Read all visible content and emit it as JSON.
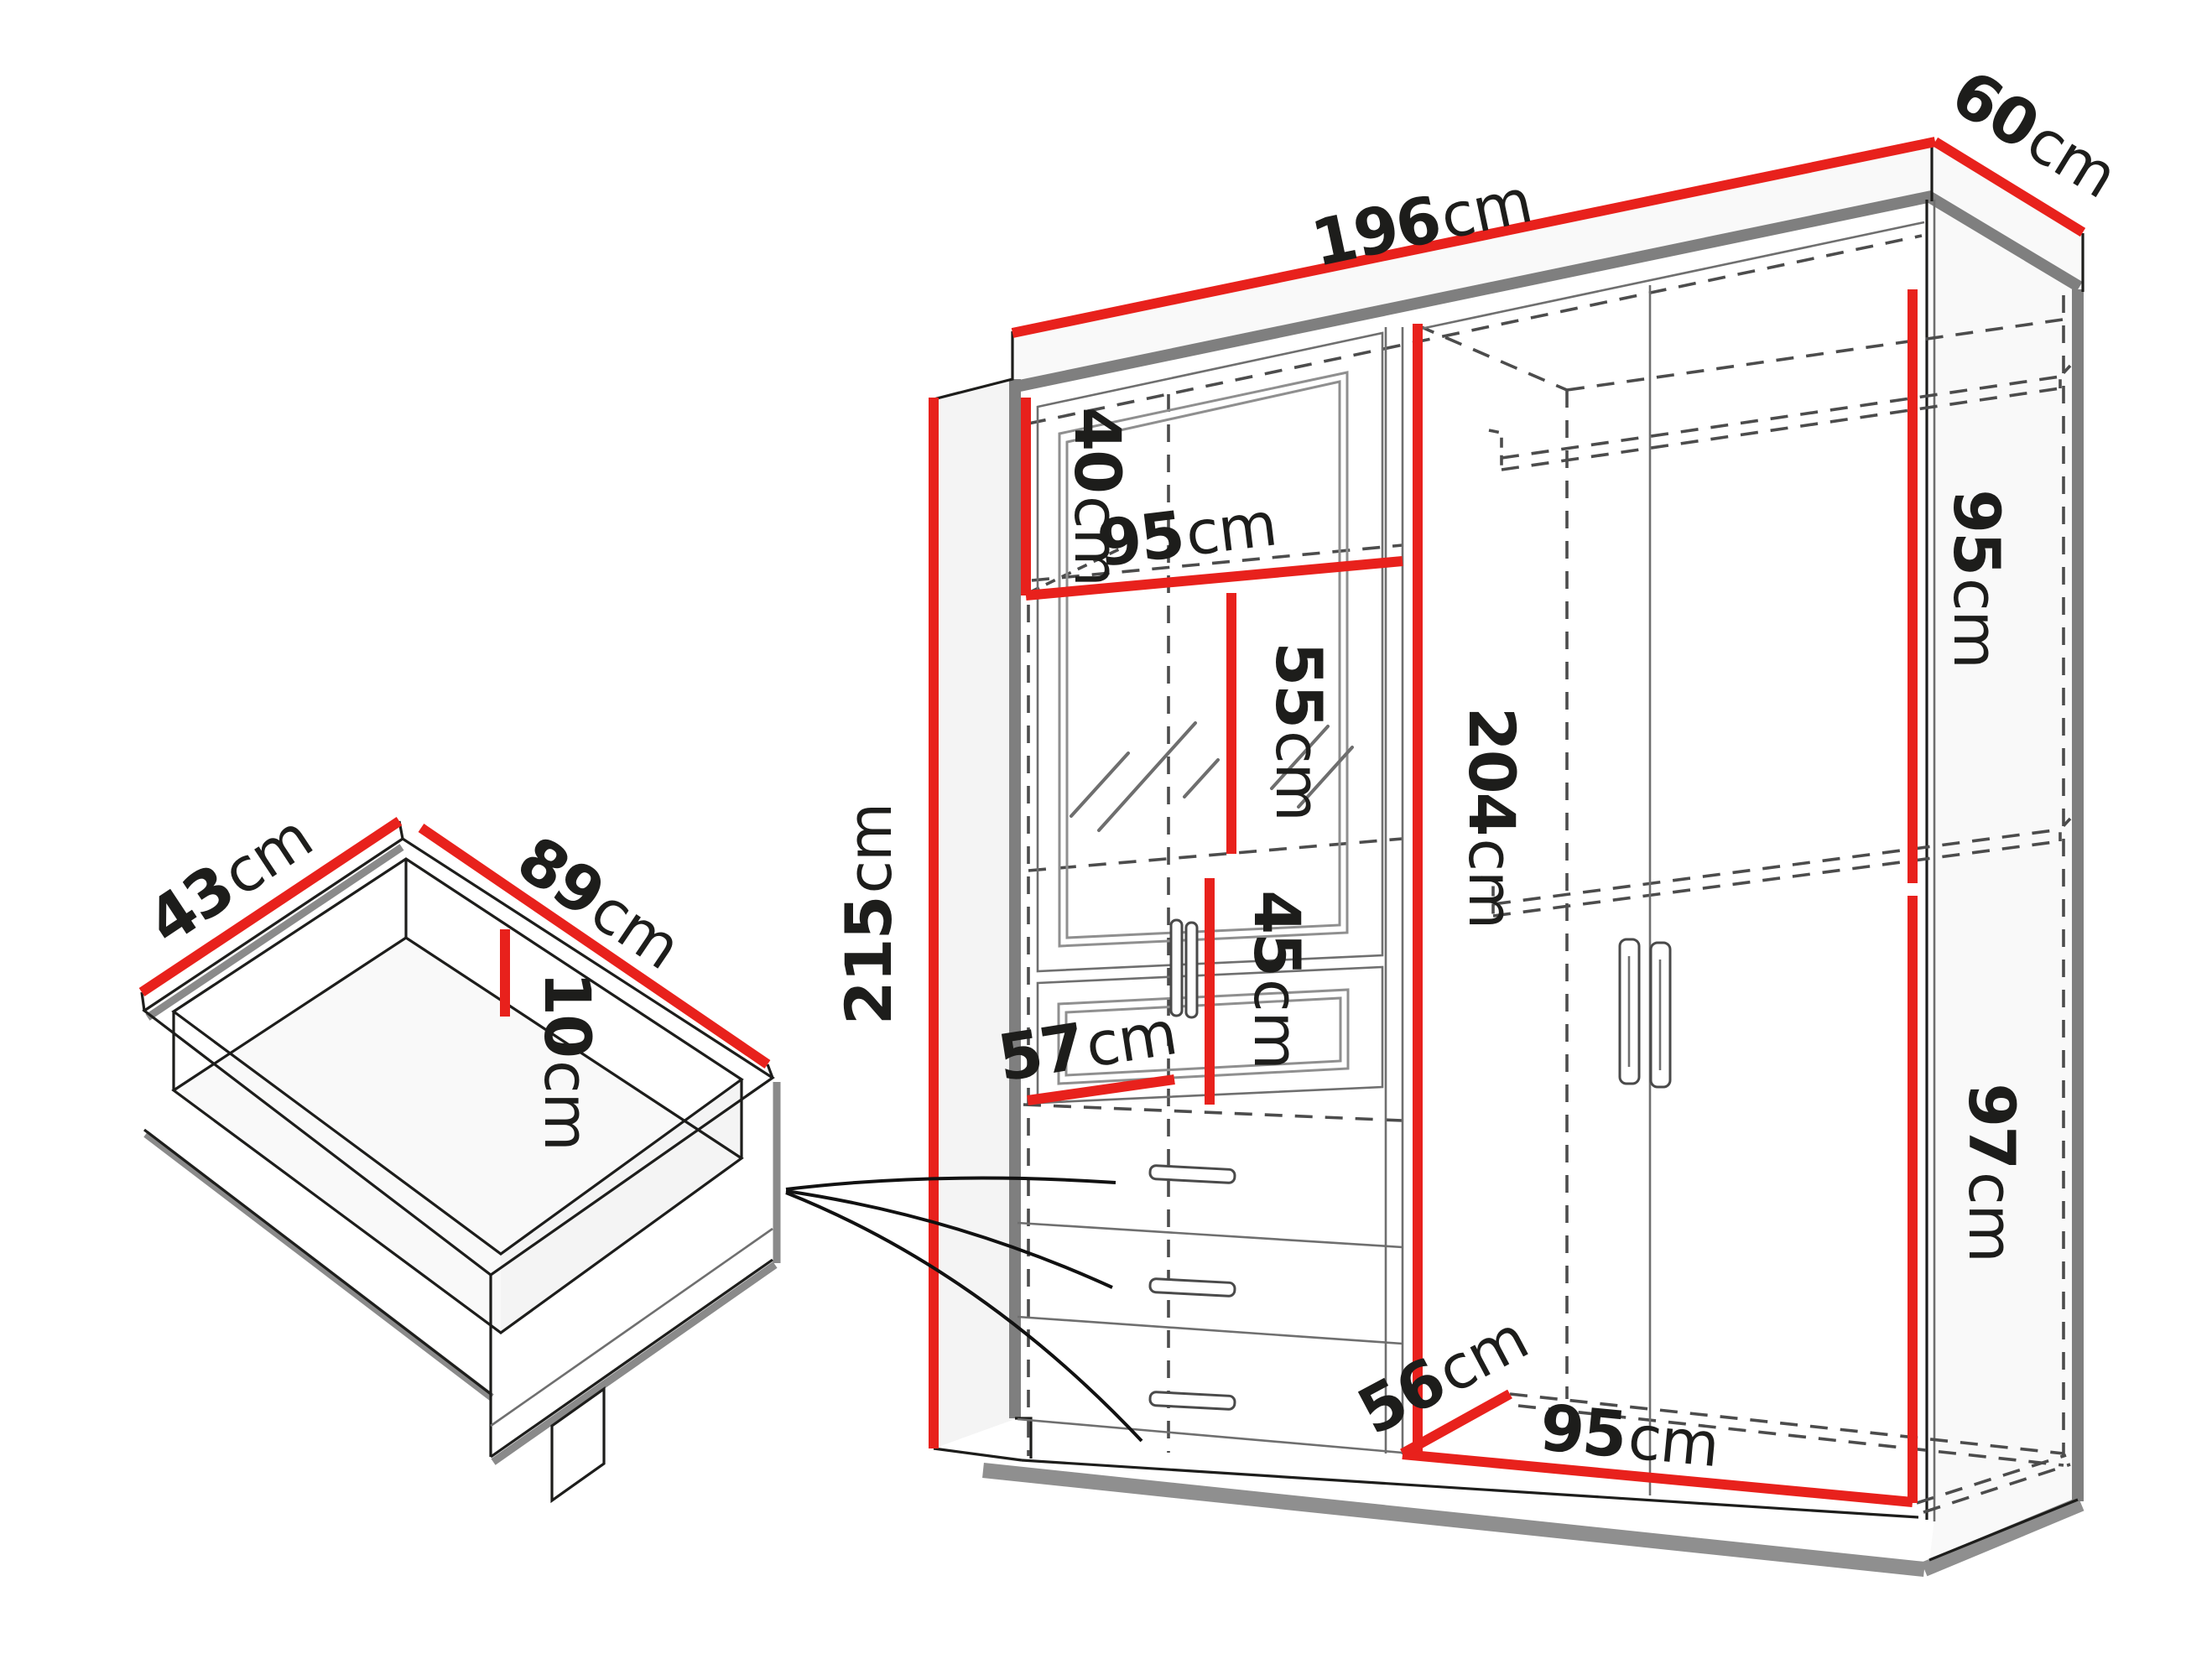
{
  "diagram": {
    "title": "Wardrobe and drawer dimension diagram",
    "unit": "cm",
    "colors": {
      "dimension_line": "#e8211c",
      "outline": "#1d1d1b",
      "hidden_line": "#4c4c4c",
      "edge_gray": "#7f7f7f"
    }
  },
  "wardrobe": {
    "width": {
      "value": "196",
      "unit": "cm"
    },
    "depth": {
      "value": "60",
      "unit": "cm"
    },
    "height": {
      "value": "215",
      "unit": "cm"
    },
    "top_shelf_height": {
      "value": "40",
      "unit": "cm"
    },
    "left_width": {
      "value": "95",
      "unit": "cm"
    },
    "mirror_height": {
      "value": "55",
      "unit": "cm"
    },
    "lower_glass_height": {
      "value": "45",
      "unit": "cm"
    },
    "interior_height": {
      "value": "204",
      "unit": "cm"
    },
    "left_depth": {
      "value": "57",
      "unit": "cm"
    },
    "upper_hang_height": {
      "value": "95",
      "unit": "cm"
    },
    "lower_hang_height": {
      "value": "97",
      "unit": "cm"
    },
    "interior_depth": {
      "value": "56",
      "unit": "cm"
    },
    "right_width": {
      "value": "95",
      "unit": "cm"
    }
  },
  "drawer": {
    "depth": {
      "value": "43",
      "unit": "cm"
    },
    "width": {
      "value": "89",
      "unit": "cm"
    },
    "height": {
      "value": "10",
      "unit": "cm"
    }
  }
}
